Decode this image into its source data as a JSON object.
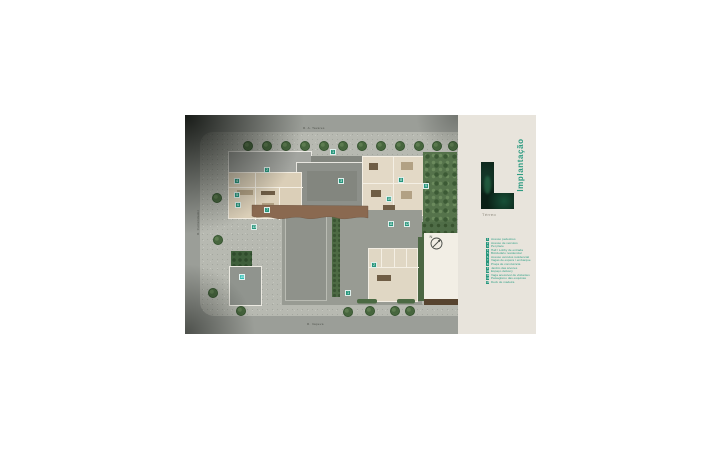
{
  "panel": {
    "title": "Implantação",
    "subtitle": "Térreo",
    "logo_name": "l-monogram-logo",
    "accent_color": "#2f9c82",
    "background_color": "#e8e4dc",
    "legend": [
      {
        "num": "1",
        "label": "Acesso pedestres"
      },
      {
        "num": "2",
        "label": "Acesso de veículos"
      },
      {
        "num": "3",
        "label": "Pet place"
      },
      {
        "num": "4",
        "label": "Hall / Lobby de entrada"
      },
      {
        "num": "5",
        "label": "Bicicletário residencial"
      },
      {
        "num": "6",
        "label": "Acesso veículos residencial"
      },
      {
        "num": "7",
        "label": "Vagas de espera / embarque"
      },
      {
        "num": "8",
        "label": "Praça de convivência"
      },
      {
        "num": "9",
        "label": "Jardim das árvores"
      },
      {
        "num": "10",
        "label": "Espaço delivery"
      },
      {
        "num": "11",
        "label": "Vaga acessível de visitantes"
      },
      {
        "num": "12",
        "label": "Paisagismo das esquinas"
      },
      {
        "num": "13",
        "label": "Deck de madeira"
      }
    ]
  },
  "plan": {
    "streets": {
      "top": "R. A. Tavares",
      "left": "R. Comendador",
      "bottom": "R. Itapeva"
    },
    "compass_label": "N",
    "marker_color": "#27967c",
    "markers": [
      {
        "num": "1",
        "x": 148,
        "y": 37
      },
      {
        "num": "2",
        "x": 82,
        "y": 55
      },
      {
        "num": "3",
        "x": 156,
        "y": 66
      },
      {
        "num": "4",
        "x": 52,
        "y": 66
      },
      {
        "num": "5",
        "x": 52,
        "y": 80
      },
      {
        "num": "6",
        "x": 53,
        "y": 90
      },
      {
        "num": "7",
        "x": 82,
        "y": 95
      },
      {
        "num": "8",
        "x": 216,
        "y": 65
      },
      {
        "num": "9",
        "x": 241,
        "y": 71
      },
      {
        "num": "10",
        "x": 204,
        "y": 84
      },
      {
        "num": "11",
        "x": 206,
        "y": 109
      },
      {
        "num": "12",
        "x": 222,
        "y": 109
      },
      {
        "num": "13",
        "x": 69,
        "y": 112
      },
      {
        "num": "2",
        "x": 189,
        "y": 150
      },
      {
        "num": "1",
        "x": 163,
        "y": 178
      },
      {
        "num": "10",
        "x": 57,
        "y": 162,
        "variant": "cyan"
      }
    ]
  }
}
